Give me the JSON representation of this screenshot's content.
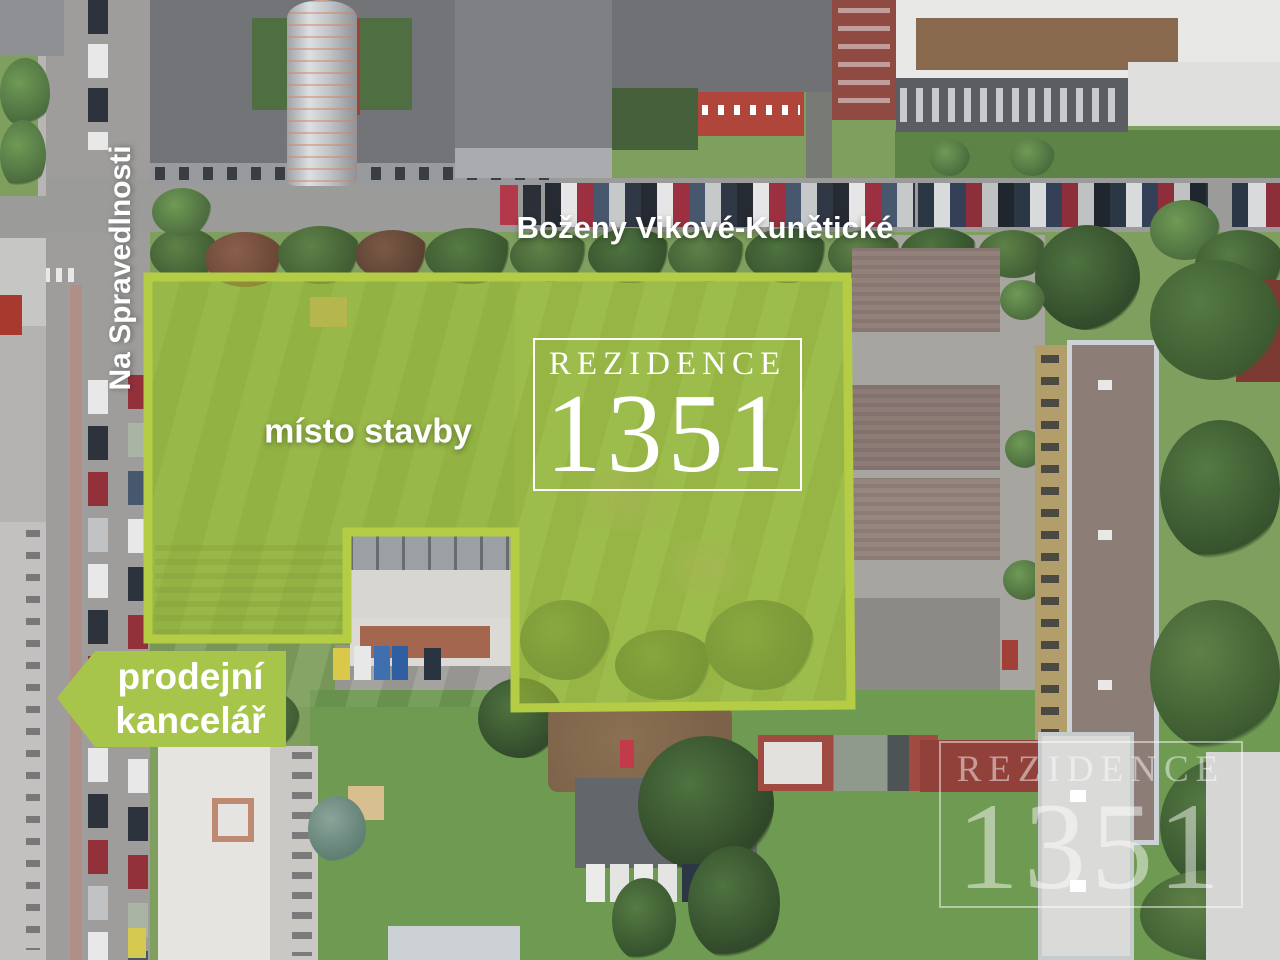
{
  "streets": {
    "horizontal_label": "Boženy Vikové-Kunětické",
    "vertical_label": "Na Spravedlnosti"
  },
  "site": {
    "label": "místo stavby"
  },
  "logo_badge": {
    "name": "REZIDENCE",
    "number": "1351"
  },
  "sales_office": {
    "line1": "prodejní",
    "line2": "kancelář"
  },
  "watermark": {
    "name": "REZIDENCE",
    "number": "1351"
  },
  "colors": {
    "highlight_border": "#b5cc45",
    "highlight_fill": "rgba(173,201,56,0.52)",
    "arrow_green": "#a7c54b",
    "label_white": "#ffffff",
    "watermark_white": "rgba(255,255,255,0.48)"
  }
}
